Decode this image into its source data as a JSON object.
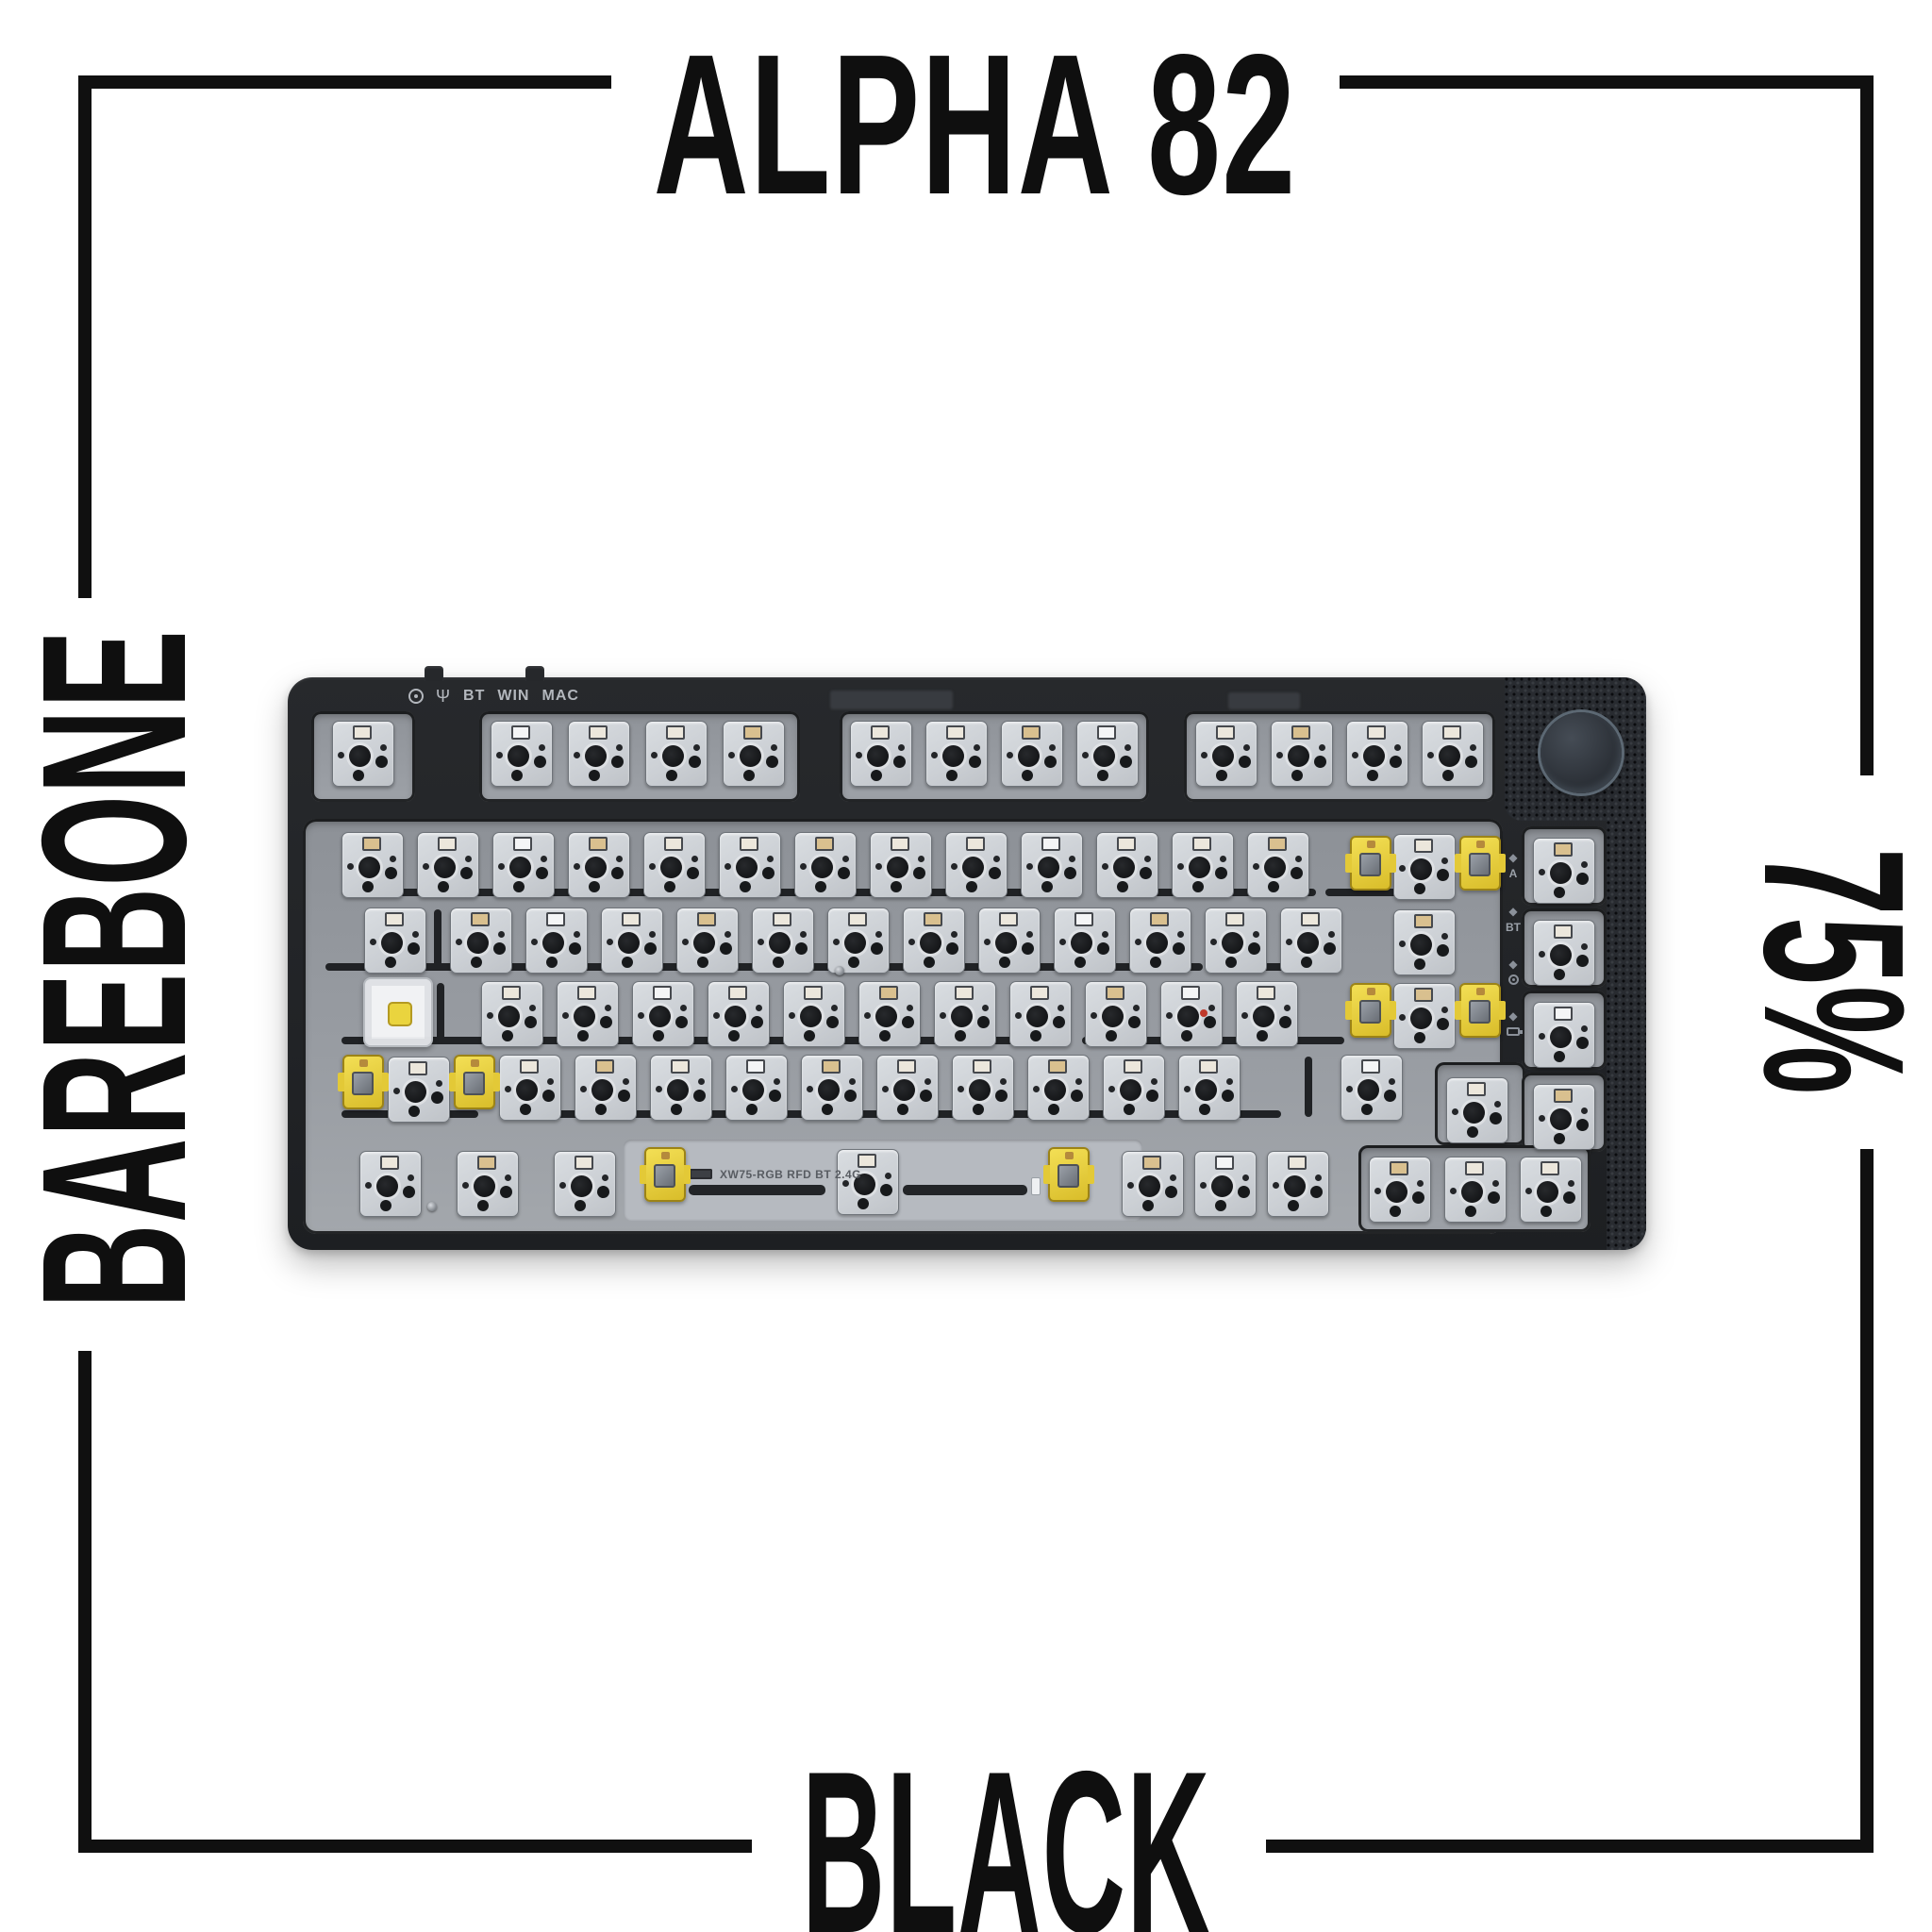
{
  "frame": {
    "title_top": "ALPHA 82",
    "left_label": "BAREBONE",
    "right_label": "75%",
    "bottom_label": "BLACK",
    "line_color": "#101010",
    "lines": [
      [
        83,
        80,
        565,
        14
      ],
      [
        83,
        80,
        14,
        554
      ],
      [
        1420,
        80,
        566,
        14
      ],
      [
        1972,
        80,
        14,
        742
      ],
      [
        83,
        1432,
        14,
        532
      ],
      [
        83,
        1950,
        714,
        14
      ],
      [
        1342,
        1950,
        644,
        14
      ],
      [
        1972,
        1218,
        14,
        746
      ]
    ]
  },
  "keyboard": {
    "top_labels": {
      "bt": "BT",
      "win": "WIN",
      "mac": "MAC"
    },
    "icons": {
      "usb_glyph": "Ψ",
      "diamond_glyph": "◆"
    },
    "indicators": [
      {
        "type": "text",
        "label": "A"
      },
      {
        "type": "text",
        "label": "BT"
      },
      {
        "type": "icon",
        "icon": "rf-icon"
      },
      {
        "type": "icon",
        "icon": "battery-icon"
      }
    ],
    "plate_text": "XW75-RGB RFD BT 2.4G",
    "colors": {
      "case": "#232528",
      "plate": "#979ba1",
      "socket": "#cfd3d7",
      "switch_yellow": "#ecd33c",
      "knob": "#343a42",
      "carbon": "#282b30"
    },
    "layout": {
      "recess": [
        16,
        150,
        1272,
        440
      ],
      "spaceplate": [
        356,
        490,
        550,
        86
      ],
      "cutouts": [
        [
          25,
          36,
          110,
          96
        ],
        [
          203,
          36,
          340,
          96
        ],
        [
          585,
          36,
          328,
          96
        ],
        [
          950,
          36,
          330,
          96
        ],
        [
          1216,
          408,
          96,
          88
        ],
        [
          1308,
          158,
          90,
          84
        ],
        [
          1308,
          245,
          90,
          84
        ],
        [
          1308,
          332,
          90,
          84
        ],
        [
          1308,
          419,
          90,
          84
        ],
        [
          1135,
          496,
          246,
          92
        ]
      ],
      "socket_runs": [
        [
          47,
          46,
          1,
          0
        ],
        [
          215,
          46,
          4,
          82
        ],
        [
          596,
          46,
          4,
          80
        ],
        [
          962,
          46,
          4,
          80
        ],
        [
          57,
          164,
          13,
          80
        ],
        [
          1172,
          166,
          1,
          0
        ],
        [
          81,
          244,
          1,
          0
        ],
        [
          172,
          244,
          12,
          80
        ],
        [
          1172,
          246,
          1,
          0
        ],
        [
          205,
          322,
          11,
          80
        ],
        [
          1172,
          324,
          1,
          0
        ],
        [
          106,
          402,
          1,
          0
        ],
        [
          224,
          400,
          10,
          80
        ],
        [
          1116,
          400,
          1,
          0
        ],
        [
          1228,
          424,
          1,
          0
        ],
        [
          76,
          502,
          1,
          0
        ],
        [
          179,
          502,
          1,
          0
        ],
        [
          282,
          502,
          1,
          0
        ],
        [
          582,
          500,
          1,
          0
        ],
        [
          884,
          502,
          3,
          77
        ],
        [
          1146,
          508,
          3,
          80
        ],
        [
          1320,
          170,
          1,
          0
        ],
        [
          1320,
          257,
          1,
          0
        ],
        [
          1320,
          344,
          1,
          0
        ],
        [
          1320,
          431,
          1,
          0
        ]
      ],
      "yellow_switches": [
        [
          1126,
          168
        ],
        [
          1242,
          168
        ],
        [
          1126,
          324
        ],
        [
          1242,
          324
        ],
        [
          58,
          400
        ],
        [
          176,
          400
        ],
        [
          378,
          498
        ],
        [
          806,
          498
        ]
      ],
      "clear_switch": [
        80,
        318
      ],
      "slots": [
        [
          57,
          224,
          425
        ],
        [
          500,
          224,
          335
        ],
        [
          860,
          224,
          230
        ],
        [
          1100,
          224,
          85
        ],
        [
          40,
          303,
          150
        ],
        [
          210,
          303,
          405
        ],
        [
          635,
          303,
          335
        ],
        [
          990,
          303,
          110
        ],
        [
          57,
          381,
          415
        ],
        [
          492,
          381,
          330
        ],
        [
          842,
          381,
          200
        ],
        [
          1055,
          381,
          65
        ],
        [
          57,
          459,
          145
        ],
        [
          224,
          459,
          325
        ],
        [
          568,
          459,
          300
        ],
        [
          888,
          459,
          165
        ]
      ],
      "vslots": [
        [
          155,
          246,
          64
        ],
        [
          158,
          324,
          64
        ],
        [
          1078,
          402,
          64
        ]
      ],
      "stabs": [
        [
          425,
          538,
          145
        ],
        [
          652,
          538,
          132
        ]
      ],
      "nubs": [
        [
          412,
          530
        ],
        [
          788,
          530
        ]
      ],
      "conn": [
        426,
        521
      ],
      "screws": [
        [
          148,
          556
        ],
        [
          580,
          306
        ]
      ],
      "red_dot": [
        967,
        352
      ],
      "ghosts": [
        [
          575,
          14,
          130,
          20
        ],
        [
          997,
          16,
          76,
          18
        ]
      ],
      "toggles_x": [
        145,
        252
      ],
      "indicator_y": [
        185,
        242,
        298,
        353
      ]
    }
  }
}
